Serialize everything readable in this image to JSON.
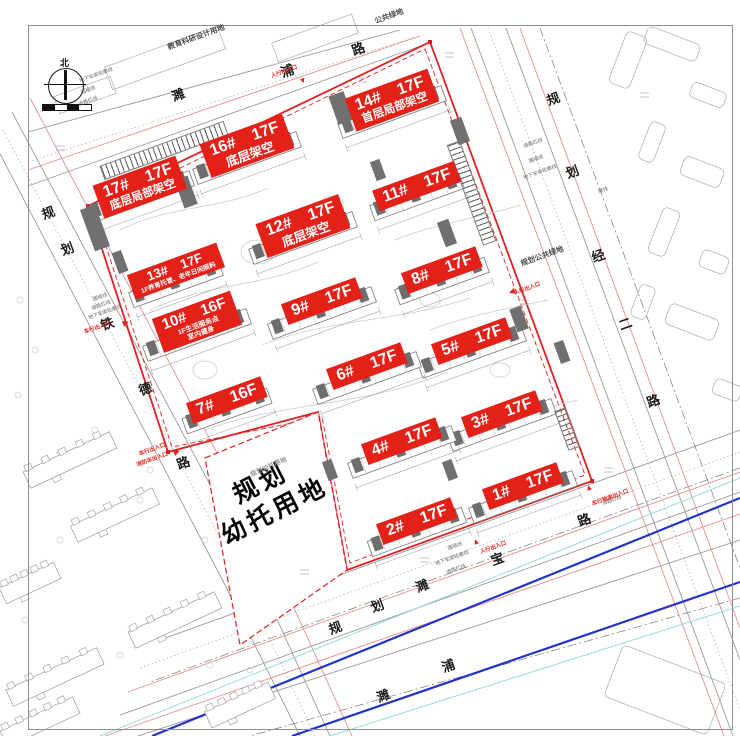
{
  "drawing": {
    "compass_north": "北",
    "kindergarten_parcel": {
      "line1": "规划",
      "line2": "幼托用地",
      "x": 268,
      "y": 498,
      "rot": -27
    },
    "building_labels": [
      {
        "num": "17#",
        "floors": "17F",
        "notes": [
          "底层局部架空"
        ],
        "x": 140,
        "y": 187,
        "rot": -20,
        "size": "md",
        "note_size": 11.5
      },
      {
        "num": "16#",
        "floors": "17F",
        "notes": [
          "底层架空"
        ],
        "x": 247,
        "y": 146,
        "rot": -20,
        "size": "md",
        "note_size": 12.5
      },
      {
        "num": "14#",
        "floors": "17F",
        "notes": [
          "首层局部架空"
        ],
        "x": 392,
        "y": 100,
        "rot": -20,
        "size": "md",
        "note_size": 11.5
      },
      {
        "num": "12#",
        "floors": "17F",
        "notes": [
          "底层架空"
        ],
        "x": 303,
        "y": 226,
        "rot": -20,
        "size": "md",
        "note_size": 12.5
      },
      {
        "num": "11#",
        "floors": "17F",
        "notes": [],
        "x": 417,
        "y": 186,
        "rot": -20,
        "size": "",
        "note_size": 0
      },
      {
        "num": "13#",
        "floors": "17F",
        "notes": [
          "1F养育托管、老年日间照料"
        ],
        "x": 176,
        "y": 271,
        "rot": -20,
        "size": "sm",
        "note_size": 6.5
      },
      {
        "num": "8#",
        "floors": "17F",
        "notes": [],
        "x": 442,
        "y": 270,
        "rot": -20,
        "size": "",
        "note_size": 0
      },
      {
        "num": "9#",
        "floors": "17F",
        "notes": [],
        "x": 322,
        "y": 301,
        "rot": -20,
        "size": "",
        "note_size": 0
      },
      {
        "num": "10#",
        "floors": "16F",
        "notes": [
          "1F生活服务点",
          "室内健身"
        ],
        "x": 197,
        "y": 322,
        "rot": -20,
        "size": "sm2",
        "note_size": 7
      },
      {
        "num": "5#",
        "floors": "17F",
        "notes": [],
        "x": 472,
        "y": 341,
        "rot": -20,
        "size": "",
        "note_size": 0
      },
      {
        "num": "6#",
        "floors": "17F",
        "notes": [],
        "x": 367,
        "y": 366,
        "rot": -20,
        "size": "",
        "note_size": 0
      },
      {
        "num": "7#",
        "floors": "16F",
        "notes": [],
        "x": 227,
        "y": 400,
        "rot": -20,
        "size": "",
        "note_size": 0
      },
      {
        "num": "3#",
        "floors": "17F",
        "notes": [],
        "x": 502,
        "y": 414,
        "rot": -20,
        "size": "",
        "note_size": 0
      },
      {
        "num": "4#",
        "floors": "17F",
        "notes": [],
        "x": 402,
        "y": 441,
        "rot": -20,
        "size": "",
        "note_size": 0
      },
      {
        "num": "1#",
        "floors": "17F",
        "notes": [],
        "x": 523,
        "y": 486,
        "rot": -20,
        "size": "",
        "note_size": 0
      },
      {
        "num": "2#",
        "floors": "17F",
        "notes": [],
        "x": 417,
        "y": 521,
        "rot": -20,
        "size": "",
        "note_size": 0
      }
    ],
    "area_labels": [
      {
        "text": "教育科研设计用地",
        "x": 196,
        "y": 37,
        "rot": -20,
        "size": 7.5
      },
      {
        "text": "公共绿地",
        "x": 389,
        "y": 16,
        "rot": -20,
        "size": 7.5
      },
      {
        "text": "规划公共绿地",
        "x": 542,
        "y": 256,
        "rot": -20,
        "size": 7.5
      },
      {
        "text": "规划幼托用地",
        "x": 268,
        "y": 466,
        "rot": -24,
        "size": 6.5
      }
    ],
    "road_chars": [
      {
        "c": "濉",
        "x": 178,
        "y": 94,
        "rot": -20
      },
      {
        "c": "浦",
        "x": 287,
        "y": 70,
        "rot": -20
      },
      {
        "c": "路",
        "x": 358,
        "y": 48,
        "rot": -20
      },
      {
        "c": "规",
        "x": 553,
        "y": 98,
        "rot": -20
      },
      {
        "c": "划",
        "x": 572,
        "y": 171,
        "rot": -20
      },
      {
        "c": "经",
        "x": 598,
        "y": 255,
        "rot": -20
      },
      {
        "c": "二",
        "x": 625,
        "y": 323,
        "rot": -20
      },
      {
        "c": "路",
        "x": 653,
        "y": 400,
        "rot": -20
      },
      {
        "c": "规",
        "x": 48,
        "y": 212,
        "rot": -20
      },
      {
        "c": "划",
        "x": 67,
        "y": 248,
        "rot": -20
      },
      {
        "c": "铁",
        "x": 107,
        "y": 323,
        "rot": -20
      },
      {
        "c": "德",
        "x": 145,
        "y": 388,
        "rot": -20
      },
      {
        "c": "路",
        "x": 183,
        "y": 462,
        "rot": -20
      },
      {
        "c": "宝",
        "x": 497,
        "y": 558,
        "rot": -20
      },
      {
        "c": "路",
        "x": 584,
        "y": 519,
        "rot": -20
      },
      {
        "c": "规",
        "x": 335,
        "y": 627,
        "rot": -20
      },
      {
        "c": "划",
        "x": 377,
        "y": 605,
        "rot": -20
      },
      {
        "c": "濉",
        "x": 422,
        "y": 585,
        "rot": -20
      },
      {
        "c": "濉",
        "x": 383,
        "y": 695,
        "rot": -20
      },
      {
        "c": "浦",
        "x": 448,
        "y": 665,
        "rot": -20
      }
    ],
    "line_notes": [
      {
        "text": "地下车库轮廓线",
        "x": 96,
        "y": 75
      },
      {
        "text": "围墙线",
        "x": 88,
        "y": 90
      },
      {
        "text": "道路红线",
        "x": 88,
        "y": 101
      },
      {
        "text": "围墙线",
        "x": 100,
        "y": 297
      },
      {
        "text": "道路红线",
        "x": 101,
        "y": 305
      },
      {
        "text": "地下车库轮廓线",
        "x": 105,
        "y": 312
      },
      {
        "text": "道路红线",
        "x": 533,
        "y": 143
      },
      {
        "text": "围墙线",
        "x": 536,
        "y": 159
      },
      {
        "text": "地下车库轮廓线",
        "x": 540,
        "y": 172
      },
      {
        "text": "绿线",
        "x": 603,
        "y": 190
      },
      {
        "text": "围墙线",
        "x": 455,
        "y": 546
      },
      {
        "text": "地下车库轮廓线",
        "x": 452,
        "y": 558
      },
      {
        "text": "道路红线",
        "x": 456,
        "y": 569
      },
      {
        "text": "道路红线",
        "x": 612,
        "y": 500
      }
    ],
    "entrances": [
      {
        "text": "人行出入口",
        "tx": 284,
        "ty": 71,
        "glyph": "▼",
        "gx": 303,
        "gy": 81,
        "rot": -20
      },
      {
        "text": "人行出入口",
        "tx": 527,
        "ty": 288,
        "glyph": "◀",
        "gx": 512,
        "gy": 292,
        "rot": -20
      },
      {
        "text": "车行出入口",
        "tx": 97,
        "ty": 327,
        "glyph": "▶",
        "gx": 126,
        "gy": 323,
        "rot": -20
      },
      {
        "text": "车行出入口",
        "tx": 152,
        "ty": 449,
        "glyph": "▶",
        "gx": 177,
        "gy": 452,
        "rot": -20
      },
      {
        "text": "消防车出入口",
        "tx": 152,
        "ty": 459,
        "glyph": "",
        "gx": 0,
        "gy": 0,
        "rot": -20
      },
      {
        "text": "人行出入口",
        "tx": 493,
        "ty": 547,
        "glyph": "▲",
        "gx": 476,
        "gy": 542,
        "rot": -20
      },
      {
        "text": "车行地库出入口",
        "tx": 610,
        "ty": 497,
        "glyph": "▲",
        "gx": 589,
        "gy": 488,
        "rot": -20
      }
    ],
    "colors": {
      "label_bg": "#e32119",
      "label_text": "#ffffff",
      "boundary_red": "#e02020",
      "river_blue": "#2233cc",
      "cyan_line": "#9adbdb",
      "road_red_line": "#e09090"
    }
  }
}
